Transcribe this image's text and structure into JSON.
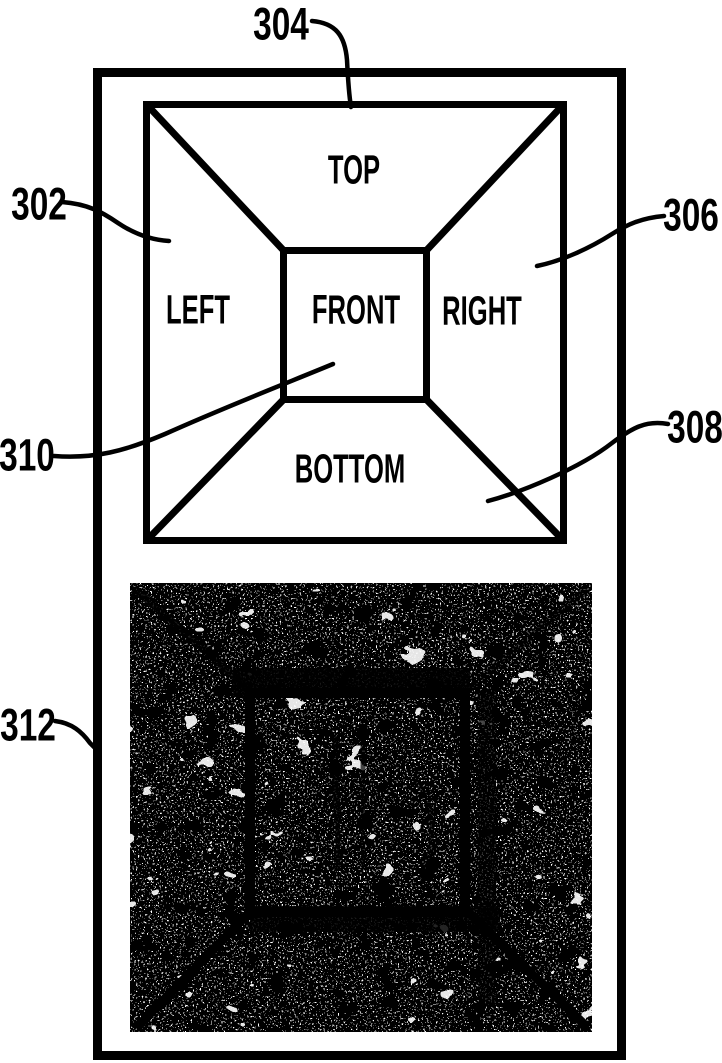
{
  "colors": {
    "ink": "#000000",
    "paper": "#ffffff"
  },
  "schematic": {
    "labels": {
      "top": "TOP",
      "left": "LEFT",
      "front": "FRONT",
      "right": "RIGHT",
      "bottom": "BOTTOM"
    }
  },
  "callouts": {
    "c302": "302",
    "c304": "304",
    "c306": "306",
    "c308": "308",
    "c310": "310",
    "c312": "312"
  }
}
